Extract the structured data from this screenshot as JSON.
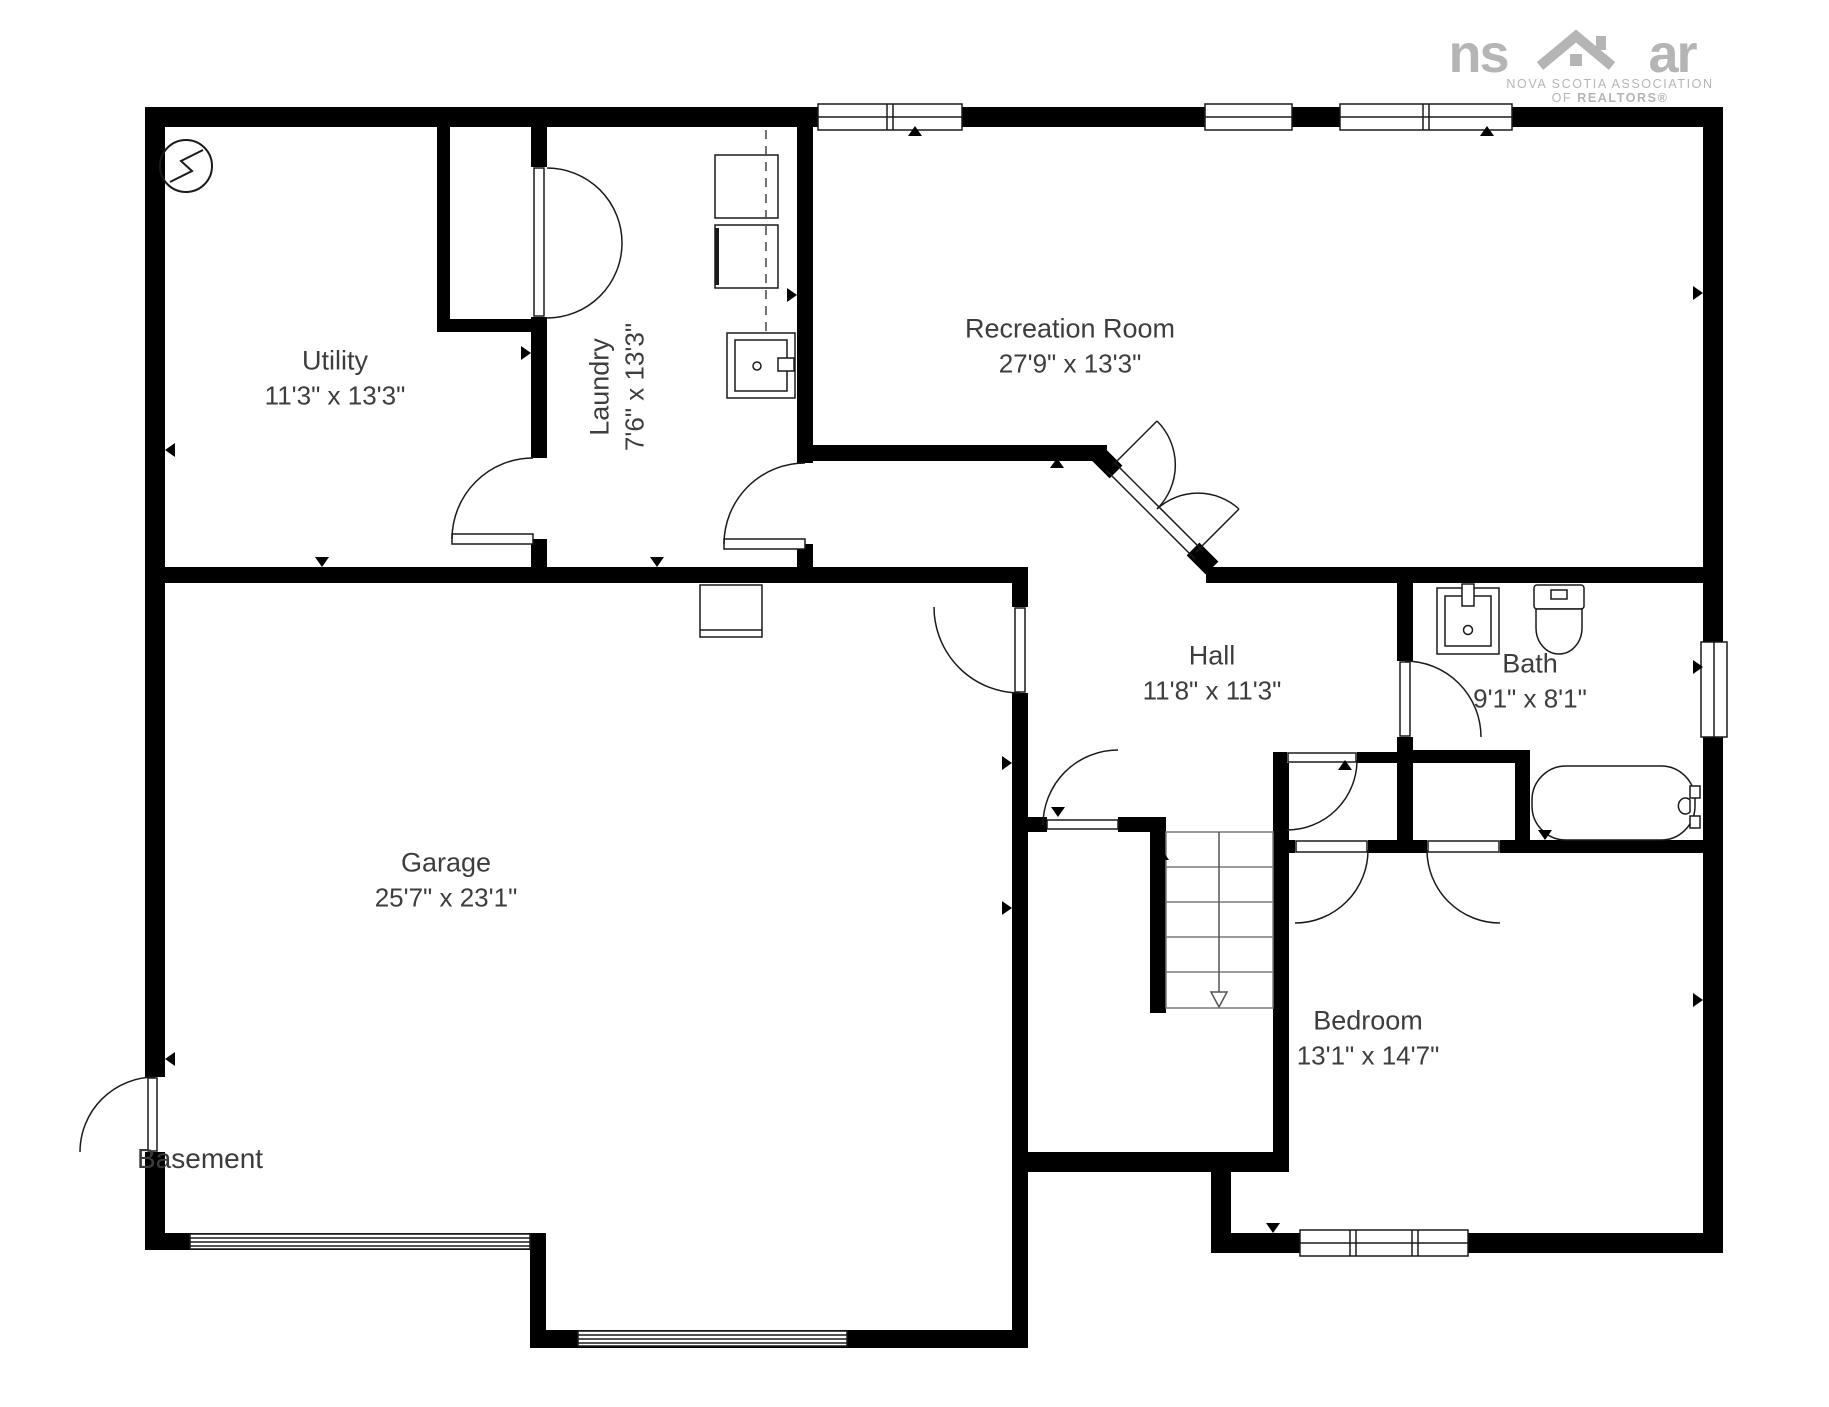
{
  "branding": {
    "logo_ns": "ns",
    "logo_ar": "ar",
    "assoc_line1": "NOVA SCOTIA ASSOCIATION",
    "assoc_line2_prefix": "OF ",
    "assoc_line2_bold": "REALTORS®"
  },
  "floor_label": "Basement",
  "rooms": {
    "utility": {
      "name": "Utility",
      "dims": "11'3\" x 13'3\""
    },
    "laundry": {
      "name": "Laundry",
      "dims": "7'6\" x 13'3\""
    },
    "recreation": {
      "name": "Recreation Room",
      "dims": "27'9\" x 13'3\""
    },
    "hall": {
      "name": "Hall",
      "dims": "11'8\" x 11'3\""
    },
    "bath": {
      "name": "Bath",
      "dims": "9'1\" x 8'1\""
    },
    "garage": {
      "name": "Garage",
      "dims": "25'7\" x 23'1\""
    },
    "bedroom": {
      "name": "Bedroom",
      "dims": "13'1\" x 14'7\""
    }
  }
}
